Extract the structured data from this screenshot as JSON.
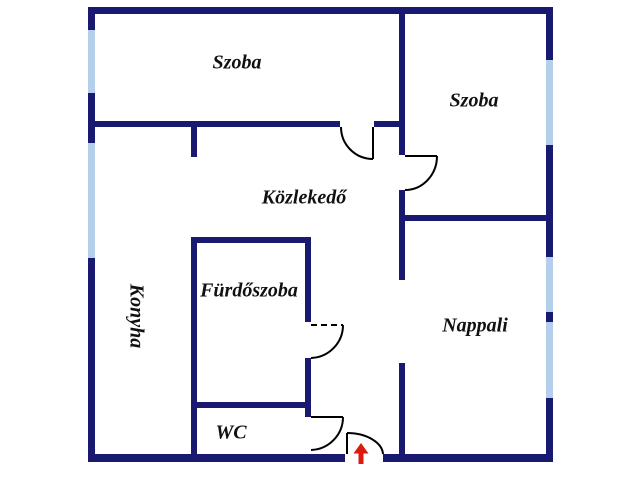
{
  "floorplan": {
    "rooms": [
      {
        "id": "szoba-1",
        "label": "Szoba"
      },
      {
        "id": "szoba-2",
        "label": "Szoba"
      },
      {
        "id": "kozlekedo",
        "label": "Közlekedő"
      },
      {
        "id": "konyha",
        "label": "Konyha"
      },
      {
        "id": "furdoszoba",
        "label": "Fürdőszoba"
      },
      {
        "id": "nappali",
        "label": "Nappali"
      },
      {
        "id": "wc",
        "label": "WC"
      }
    ],
    "colors": {
      "wall": "#191970",
      "window": "#b3cfe9",
      "door_line": "#000000",
      "entrance_arrow": "#dc1a10",
      "background": "#ffffff",
      "text": "#111111"
    }
  }
}
